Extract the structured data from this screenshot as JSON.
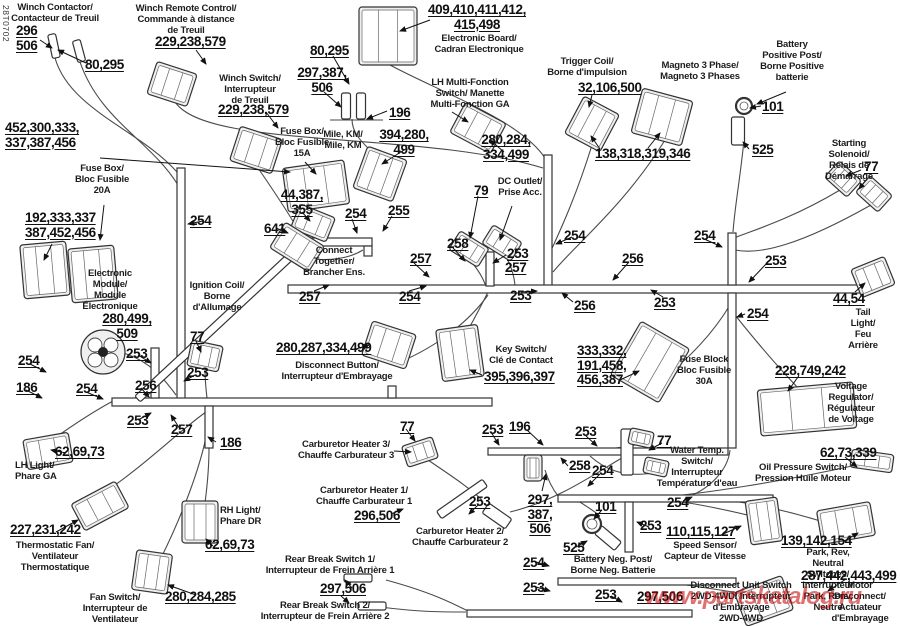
{
  "meta": {
    "diagram_code": "28T0702",
    "watermark": "www.partskatalog.ru"
  },
  "texts": [
    {
      "id": "winch-contactor",
      "kind": "name",
      "text": "Winch Contactor/\nContacteur de Treuil"
    },
    {
      "id": "winch-remote",
      "kind": "name",
      "text": "Winch Remote Control/\nCommande à distance\nde Treuil"
    },
    {
      "id": "winch-switch",
      "kind": "name",
      "text": "Winch Switch/\nInterrupteur\nde Treuil"
    },
    {
      "id": "electronic-board",
      "kind": "name",
      "text": "Electronic Board/\nCadran Electronique"
    },
    {
      "id": "lh-multifunction",
      "kind": "name",
      "text": "LH Multi-Fonction\nSwitch/ Manette\nMulti-Fonction GA"
    },
    {
      "id": "mile-km",
      "kind": "name",
      "text": "Mile, KM/\nMile, KM"
    },
    {
      "id": "fuse-box-15",
      "kind": "name",
      "text": "Fuse Box/\nBloc Fusible\n15A"
    },
    {
      "id": "fuse-box-20",
      "kind": "name",
      "text": "Fuse Box/\nBloc Fusible\n20A"
    },
    {
      "id": "electronic-module",
      "kind": "name",
      "text": "Electronic\nModule/\nModule\nÉlectronique"
    },
    {
      "id": "ignition-coil",
      "kind": "name",
      "text": "Ignition Coil/\nBorne\nd'Allumage"
    },
    {
      "id": "connect-together",
      "kind": "name",
      "text": "Connect\nTogether/\nBrancher Ens."
    },
    {
      "id": "trigger-coil",
      "kind": "name",
      "text": "Trigger Coil/\nBorne d'impulsion"
    },
    {
      "id": "magneto",
      "kind": "name",
      "text": "Magneto 3 Phase/\nMagneto 3 Phases"
    },
    {
      "id": "battery-positive",
      "kind": "name",
      "text": "Battery\nPositive Post/\nBorne Positive\nbatterie"
    },
    {
      "id": "starting-solenoid",
      "kind": "name",
      "text": "Starting Solenoid/\nRelais de Démarrage"
    },
    {
      "id": "dc-outlet",
      "kind": "name",
      "text": "DC Outlet/\nPrise Acc."
    },
    {
      "id": "disconnect-button",
      "kind": "name",
      "text": "Disconnect Button/\nInterrupteur d'Embrayage"
    },
    {
      "id": "key-switch",
      "kind": "name",
      "text": "Key Switch/\nClé de Contact"
    },
    {
      "id": "fuse-block-30",
      "kind": "name",
      "text": "Fuse Block\nBloc Fusible\n30A"
    },
    {
      "id": "voltage-regulator",
      "kind": "name",
      "text": "Voltage Regulator/\nRégulateur\nde Voltage"
    },
    {
      "id": "tail-light",
      "kind": "name",
      "text": "Tail Light/\nFeu Arrière"
    },
    {
      "id": "lh-light",
      "kind": "name",
      "text": "LH Light/\nPhare GA"
    },
    {
      "id": "rh-light",
      "kind": "name",
      "text": "RH Light/\nPhare DR"
    },
    {
      "id": "thermostatic-fan",
      "kind": "name",
      "text": "Thermostatic Fan/\nVentilateur\nThermostatique"
    },
    {
      "id": "fan-switch",
      "kind": "name",
      "text": "Fan Switch/\nInterrupteur de\nVentilateur"
    },
    {
      "id": "carb-heater-3",
      "kind": "name",
      "text": "Carburetor Heater 3/\nChauffe Carburateur 3"
    },
    {
      "id": "carb-heater-1",
      "kind": "name",
      "text": "Carburetor Heater 1/\nChauffe Carburateur 1"
    },
    {
      "id": "carb-heater-2",
      "kind": "name",
      "text": "Carburetor Heater 2/\nChauffe Carburateur 2"
    },
    {
      "id": "rear-break-1",
      "kind": "name",
      "text": "Rear Break Switch 1/\nInterrupteur de Frein Arrière 1"
    },
    {
      "id": "rear-break-2",
      "kind": "name",
      "text": "Rear Break Switch 2/\nInterrupteur de Frein Arrière 2"
    },
    {
      "id": "water-temp",
      "kind": "name",
      "text": "Water Temp.\nSwitch/\nInterrupteur\nTempérature d'eau"
    },
    {
      "id": "oil-pressure",
      "kind": "name",
      "text": "Oil Pressure Switch/\nPression Huile Moteur"
    },
    {
      "id": "battery-neg",
      "kind": "name",
      "text": "Battery Neg. Post/\nBorne Neg. Batterie"
    },
    {
      "id": "speed-sensor",
      "kind": "name",
      "text": "Speed Sensor/\nCapteur de Vitesse"
    },
    {
      "id": "park-rev-neutral",
      "kind": "name",
      "text": "Park, Rev, Neutral Switches/\nInterrupteur Park, Renv, Neutre"
    },
    {
      "id": "motor-disconnect",
      "kind": "name",
      "text": "Motor\nDisconnect/\nActuateur\nd'Embrayage"
    },
    {
      "id": "disconnect-unit",
      "kind": "name",
      "text": "Disconnect Unit Switch\n2WD-4WD/ Interrupteur\nd'Embrayage\n2WD-4WD"
    },
    {
      "id": "m-296-506",
      "kind": "num",
      "text": "296\n506"
    },
    {
      "id": "m-80-295-a",
      "kind": "num",
      "text": "80,295"
    },
    {
      "id": "m-229-a",
      "kind": "num",
      "text": "229,238,579"
    },
    {
      "id": "m-229-b",
      "kind": "num",
      "text": "229,238,579"
    },
    {
      "id": "m-452",
      "kind": "num",
      "text": "452,300,333,\n337,387,456"
    },
    {
      "id": "m-192",
      "kind": "num",
      "text": "192,333,337\n387,452,456"
    },
    {
      "id": "m-280-499-509",
      "kind": "num",
      "text": "280,499,\n509"
    },
    {
      "id": "m-409",
      "kind": "num",
      "text": "409,410,411,412,\n415,498"
    },
    {
      "id": "m-80-295-b",
      "kind": "num",
      "text": "80,295"
    },
    {
      "id": "m-297-387-506-a",
      "kind": "num",
      "text": "297,387,\n506"
    },
    {
      "id": "m-196-a",
      "kind": "num",
      "text": "196"
    },
    {
      "id": "m-394",
      "kind": "num",
      "text": "394,280,\n499"
    },
    {
      "id": "m-280-284-334",
      "kind": "num",
      "text": "280,284,\n334,499"
    },
    {
      "id": "m-32-106-500",
      "kind": "num",
      "text": "32,106,500"
    },
    {
      "id": "m-138-318",
      "kind": "num",
      "text": "138,318,319,346"
    },
    {
      "id": "m-101-a",
      "kind": "num",
      "text": "101"
    },
    {
      "id": "m-525-a",
      "kind": "num",
      "text": "525"
    },
    {
      "id": "m-77-a",
      "kind": "num",
      "text": "77"
    },
    {
      "id": "m-44-387-355",
      "kind": "num",
      "text": "44,387,\n355"
    },
    {
      "id": "m-641",
      "kind": "num",
      "text": "641"
    },
    {
      "id": "m-254-a",
      "kind": "num",
      "text": "254"
    },
    {
      "id": "m-255",
      "kind": "num",
      "text": "255"
    },
    {
      "id": "m-257-a",
      "kind": "num",
      "text": "257"
    },
    {
      "id": "m-258-a",
      "kind": "num",
      "text": "258"
    },
    {
      "id": "m-79",
      "kind": "num",
      "text": "79"
    },
    {
      "id": "m-253-a",
      "kind": "num",
      "text": "253"
    },
    {
      "id": "m-257-b",
      "kind": "num",
      "text": "257"
    },
    {
      "id": "m-254-b",
      "kind": "num",
      "text": "254"
    },
    {
      "id": "m-254-c",
      "kind": "num",
      "text": "254"
    },
    {
      "id": "m-256-a",
      "kind": "num",
      "text": "256"
    },
    {
      "id": "m-254-d",
      "kind": "num",
      "text": "254"
    },
    {
      "id": "m-253-b",
      "kind": "num",
      "text": "253"
    },
    {
      "id": "m-257-c",
      "kind": "num",
      "text": "257"
    },
    {
      "id": "m-254-e",
      "kind": "num",
      "text": "254"
    },
    {
      "id": "m-253-c",
      "kind": "num",
      "text": "253"
    },
    {
      "id": "m-256-b",
      "kind": "num",
      "text": "256"
    },
    {
      "id": "m-253-d",
      "kind": "num",
      "text": "253"
    },
    {
      "id": "m-44-54",
      "kind": "num",
      "text": "44,54"
    },
    {
      "id": "m-254-f",
      "kind": "num",
      "text": "254"
    },
    {
      "id": "m-253-e",
      "kind": "num",
      "text": "253"
    },
    {
      "id": "m-254-g",
      "kind": "num",
      "text": "254"
    },
    {
      "id": "m-186-a",
      "kind": "num",
      "text": "186"
    },
    {
      "id": "m-254-h",
      "kind": "num",
      "text": "254"
    },
    {
      "id": "m-256-c",
      "kind": "num",
      "text": "256"
    },
    {
      "id": "m-253-f",
      "kind": "num",
      "text": "253"
    },
    {
      "id": "m-253-g",
      "kind": "num",
      "text": "253"
    },
    {
      "id": "m-257-d",
      "kind": "num",
      "text": "257"
    },
    {
      "id": "m-186-b",
      "kind": "num",
      "text": "186"
    },
    {
      "id": "m-77-b",
      "kind": "num",
      "text": "77"
    },
    {
      "id": "m-62-69-73-a",
      "kind": "num",
      "text": "62,69,73"
    },
    {
      "id": "m-227",
      "kind": "num",
      "text": "227,231,242"
    },
    {
      "id": "m-280-287",
      "kind": "num",
      "text": "280,287,334,499"
    },
    {
      "id": "m-395",
      "kind": "num",
      "text": "395,396,397"
    },
    {
      "id": "m-333",
      "kind": "num",
      "text": "333,332,\n191,458,\n456,387"
    },
    {
      "id": "m-228",
      "kind": "num",
      "text": "228,749,242"
    },
    {
      "id": "m-62-73-339",
      "kind": "num",
      "text": "62,73,339"
    },
    {
      "id": "m-77-c",
      "kind": "num",
      "text": "77"
    },
    {
      "id": "m-253-h",
      "kind": "num",
      "text": "253"
    },
    {
      "id": "m-196-b",
      "kind": "num",
      "text": "196"
    },
    {
      "id": "m-253-i",
      "kind": "num",
      "text": "253"
    },
    {
      "id": "m-258-b",
      "kind": "num",
      "text": "258"
    },
    {
      "id": "m-254-i",
      "kind": "num",
      "text": "254"
    },
    {
      "id": "m-77-d",
      "kind": "num",
      "text": "77"
    },
    {
      "id": "m-296-506-b",
      "kind": "num",
      "text": "296,506"
    },
    {
      "id": "m-253-j",
      "kind": "num",
      "text": "253"
    },
    {
      "id": "m-297-387-506-b",
      "kind": "num",
      "text": "297,\n387,\n506"
    },
    {
      "id": "m-101-b",
      "kind": "num",
      "text": "101"
    },
    {
      "id": "m-525-b",
      "kind": "num",
      "text": "525"
    },
    {
      "id": "m-254-j",
      "kind": "num",
      "text": "254"
    },
    {
      "id": "m-253-k",
      "kind": "num",
      "text": "253"
    },
    {
      "id": "m-110",
      "kind": "num",
      "text": "110,115,127"
    },
    {
      "id": "m-139",
      "kind": "num",
      "text": "139,142,154"
    },
    {
      "id": "m-287-442",
      "kind": "num",
      "text": "287,442,443,499"
    },
    {
      "id": "m-254-k",
      "kind": "num",
      "text": "254"
    },
    {
      "id": "m-253-l",
      "kind": "num",
      "text": "253"
    },
    {
      "id": "m-253-m",
      "kind": "num",
      "text": "253"
    },
    {
      "id": "m-297-506-a",
      "kind": "num",
      "text": "297,506"
    },
    {
      "id": "m-297-506-c",
      "kind": "num",
      "text": "297,506"
    },
    {
      "id": "m-62-69-73-b",
      "kind": "num",
      "text": "62,69,73"
    },
    {
      "id": "m-280-284-285",
      "kind": "num",
      "text": "280,284,285"
    }
  ]
}
